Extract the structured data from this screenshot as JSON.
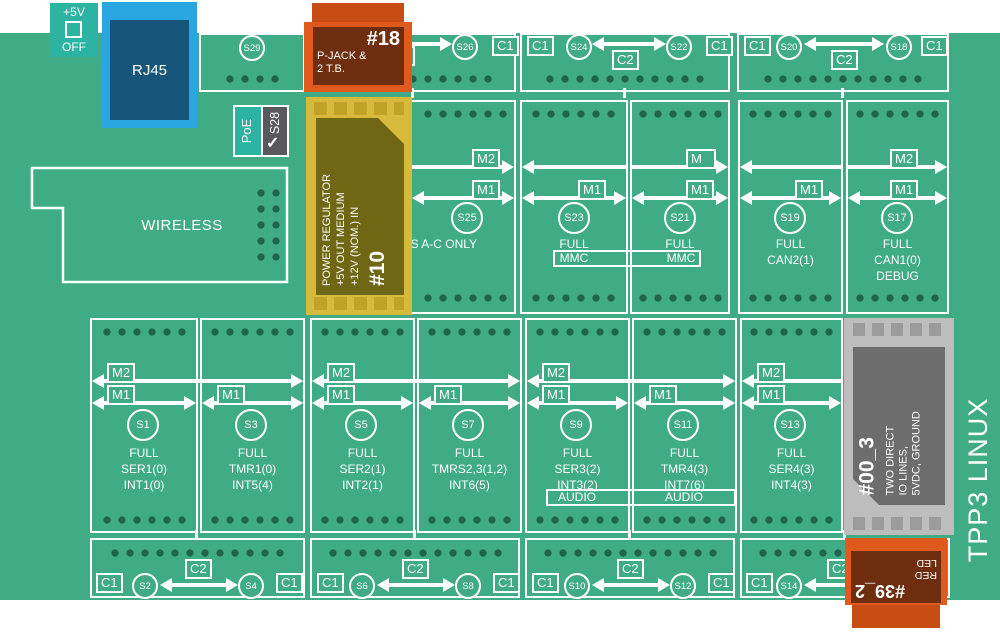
{
  "title": {
    "vertical": "TPP3 LINUX"
  },
  "power5v": {
    "top": "+5V",
    "bottom": "OFF"
  },
  "rj45": {
    "label": "RJ45"
  },
  "wireless": {
    "label": "WIRELESS"
  },
  "poe": {
    "label": "PoE",
    "switch": "S28",
    "check": "✓"
  },
  "labels": {
    "c1": "C1",
    "c2": "C2",
    "m1": "M1",
    "m2": "M2",
    "m_blank": "M"
  },
  "mod18": {
    "id": "#18",
    "l1": "P-JACK &",
    "l2": "2 T.B."
  },
  "mod10": {
    "id": "#10",
    "l1": "+12V (NOM.) IN",
    "l2": "+5V OUT MEDIUM",
    "l3": "POWER REGULATOR"
  },
  "mod00": {
    "id": "#00_3",
    "l1": "TWO DIRECT",
    "l2": "IO LINES,",
    "l3": "5VDC, GROUND"
  },
  "mod39": {
    "id": "#39_2",
    "l1": "RED",
    "l2": "LED"
  },
  "row1": {
    "s29": "S29",
    "s26": "S26",
    "s24": "S24",
    "s22": "S22",
    "s20": "S20",
    "s18": "S18"
  },
  "row2": {
    "s25": {
      "id": "S25",
      "note": "LINES A-C ONLY"
    },
    "s23": {
      "id": "S23",
      "l1": "FULL",
      "tag": "MMC"
    },
    "s21": {
      "id": "S21",
      "l1": "FULL",
      "tag": "MMC"
    },
    "s19": {
      "id": "S19",
      "l1": "FULL",
      "l2": "CAN2(1)"
    },
    "s17": {
      "id": "S17",
      "l1": "FULL",
      "l2": "CAN1(0)",
      "l3": "DEBUG"
    }
  },
  "row3": {
    "s1": {
      "id": "S1",
      "l1": "FULL",
      "l2": "SER1(0)",
      "l3": "INT1(0)"
    },
    "s3": {
      "id": "S3",
      "l1": "FULL",
      "l2": "TMR1(0)",
      "l3": "INT5(4)"
    },
    "s5": {
      "id": "S5",
      "l1": "FULL",
      "l2": "SER2(1)",
      "l3": "INT2(1)"
    },
    "s7": {
      "id": "S7",
      "l1": "FULL",
      "l2": "TMRS2,3(1,2)",
      "l3": "INT6(5)"
    },
    "s9": {
      "id": "S9",
      "l1": "FULL",
      "l2": "SER3(2)",
      "l3": "INT3(2)",
      "tag": "AUDIO"
    },
    "s11": {
      "id": "S11",
      "l1": "FULL",
      "l2": "TMR4(3)",
      "l3": "INT7(6)",
      "tag": "AUDIO"
    },
    "s13": {
      "id": "S13",
      "l1": "FULL",
      "l2": "SER4(3)",
      "l3": "INT4(3)"
    }
  },
  "row4": {
    "s2": "S2",
    "s4": "S4",
    "s6": "S6",
    "s8": "S8",
    "s10": "S10",
    "s12": "S12",
    "s14": "S14"
  }
}
